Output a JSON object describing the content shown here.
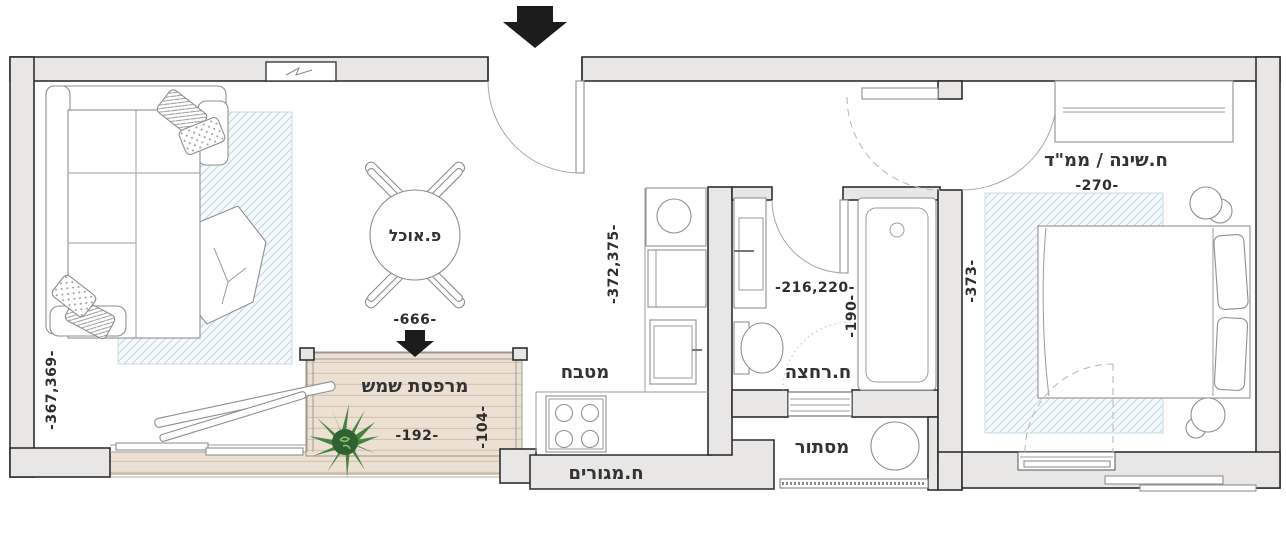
{
  "labels": {
    "living_room": "ח.מגורים",
    "dining": "פ.אוכל",
    "balcony": "מרפסת שמש",
    "kitchen": "מטבח",
    "bathroom": "ח.רחצה",
    "utility": "מסתור",
    "bedroom": "ח.שינה / ממ\"ד"
  },
  "dimensions": {
    "living_width": "-666-",
    "living_depth": "-367,369-",
    "kitchen_depth": "-372,375-",
    "balcony_width": "-192-",
    "balcony_depth": "-104-",
    "bathroom_size": "-216,220-",
    "bathroom_depth": "-190-",
    "bedroom_width": "-270-",
    "bedroom_depth": "-373-"
  },
  "colors": {
    "wall_fill": "#e8e7e5",
    "wall_stroke": "#2f2f2f",
    "deck_fill": "#ece0d3",
    "deck_plank": "#d5c5b1",
    "rug_hatch": "#c2d9e3",
    "plant_green": "#47833f",
    "arrow_black": "#1c1c1c",
    "text": "#333333"
  }
}
